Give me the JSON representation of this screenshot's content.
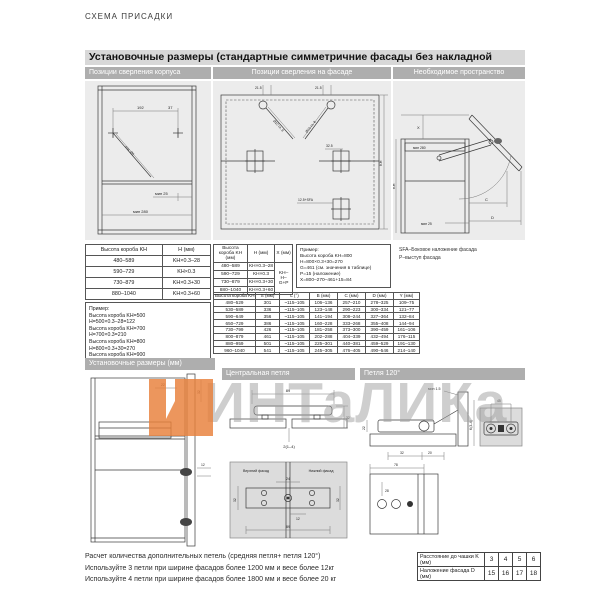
{
  "doc_header": "СХЕМА ПРИСАДКИ",
  "sections": {
    "s1": {
      "title": "Установочные размеры (стандартные симметричние фасады без накладной ручки)",
      "col1": "Позиции сверления корпуса",
      "col2": "Позиции сверления на фасаде",
      "col3": "Необходимое пространство"
    },
    "s2": {
      "col1": "Установочные размеры (мм)",
      "col2": "Центральная петля",
      "col3": "Петля 120°"
    }
  },
  "table_kh": {
    "headers": [
      "Высота короба KH",
      "H (мм)"
    ],
    "rows": [
      [
        "480–589",
        "KH×0.3–28"
      ],
      [
        "590–729",
        "KH×0.3"
      ],
      [
        "730–879",
        "KH×0.3+30"
      ],
      [
        "880–1040",
        "KH×0.3+60"
      ]
    ],
    "example": [
      "Пример:",
      "Высота короба KH=500",
      "H=500×0.3–28=122",
      "Высота короба KH=700",
      "H=700×0.3=210",
      "Высота короба KH=800",
      "H=800×0.3+30=270",
      "Высота короба KH=900",
      "H=900×0.3+60=330"
    ]
  },
  "table_khx": {
    "headers": [
      "Высота короба KH (мм)",
      "H (мм)",
      "X (мм)"
    ],
    "rows": [
      [
        "480–589",
        "KH×0.3–28"
      ],
      [
        "590–729",
        "KH×0.3"
      ],
      [
        "730–879",
        "KH×0.3+30"
      ],
      [
        "880–1040",
        "KH×0.3+60"
      ]
    ],
    "x_formula": "KH–H–G+P",
    "example": [
      "Пример:",
      "Высота короба KH=800",
      "H=800×0.3+30=270",
      "G=461 (см. значения в таблице)",
      "P=15 (наложение)",
      "X=800–270–461+15=84"
    ]
  },
  "table_main": {
    "headers": [
      "Высота короба KH (мм)",
      "S (мм)",
      "L (°)",
      "B (мм)",
      "C (мм)",
      "D (мм)",
      "Y (мм)"
    ],
    "rows": [
      [
        "480–529",
        "301",
        "~115–105",
        "106–136",
        "257–210",
        "278–325",
        "109–75"
      ],
      [
        "530–589",
        "336",
        "~115–105",
        "123–148",
        "290–223",
        "300–334",
        "121–77"
      ],
      [
        "590–649",
        "356",
        "~115–105",
        "141–194",
        "308–244",
        "327–364",
        "132–84"
      ],
      [
        "650–729",
        "386",
        "~115–105",
        "160–228",
        "333–268",
        "355–408",
        "144–94"
      ],
      [
        "730–799",
        "426",
        "~115–105",
        "181–258",
        "373–300",
        "390–459",
        "161–106"
      ],
      [
        "800–879",
        "461",
        "~115–105",
        "202–288",
        "404–339",
        "432–494",
        "176–115"
      ],
      [
        "880–959",
        "501",
        "~115–105",
        "225–301",
        "440–381",
        "459–529",
        "191–130"
      ],
      [
        "960–1040",
        "541",
        "~115–105",
        "245–305",
        "476–405",
        "490–546",
        "214–140"
      ]
    ]
  },
  "side_note": {
    "line1": "SFA–Боковое наложение фасада",
    "line2": "P–выступ фасада"
  },
  "drawings": {
    "housing": {
      "d192": "192",
      "d37": "37",
      "diag": "отв. Ø5",
      "min25": "мин 25",
      "min280": "мин 280"
    },
    "facade": {
      "t215l": "21.5",
      "t215r": "21.5",
      "drill_l": "Ø10 гл. 8",
      "drill_r": "Ø10 гл. 8",
      "d325": "32.5",
      "sfa": "12.5+SFA",
      "kh": "KH"
    },
    "space": {
      "x": "X",
      "min280": "мин 280",
      "min25": "мин 25",
      "c": "C",
      "d": "D",
      "kh": "KH"
    },
    "cabinet2": {
      "d22": "22",
      "d32": "32",
      "d12": "12"
    },
    "central": {
      "d89": "89",
      "d32": "32",
      "gap": "2(1–4)",
      "upper": "Верхний фасад",
      "lower": "Нижний фасад",
      "d24": "24",
      "d32l": "32",
      "d32r": "32",
      "d12": "12",
      "d89b": "89"
    },
    "hinge120": {
      "min15": "мин 1.5",
      "d22": "22",
      "d32": "32",
      "d20": "20",
      "k": "K(3–6)",
      "d45": "45",
      "d78": "78",
      "d28": "28"
    }
  },
  "watermark": {
    "text": "ИНТаЛИКа",
    "logo_color": "#e87f3a"
  },
  "footer": {
    "lines": [
      "Расчет  количества дополнительных петель (средняя петля+ петля 120°)",
      "Используйте 3 петли при ширине фасадов более 1200 мм и весе более 12кг",
      "Используйте 4 петли при ширине фасадов более 1800 мм и весе более 20 кг"
    ],
    "table": {
      "rows": [
        {
          "label": "Расстояние до чашки K (мм)",
          "values": [
            "3",
            "4",
            "5",
            "6"
          ]
        },
        {
          "label": "Наложение фасада D (мм)",
          "values": [
            "15",
            "16",
            "17",
            "18"
          ]
        }
      ]
    }
  }
}
